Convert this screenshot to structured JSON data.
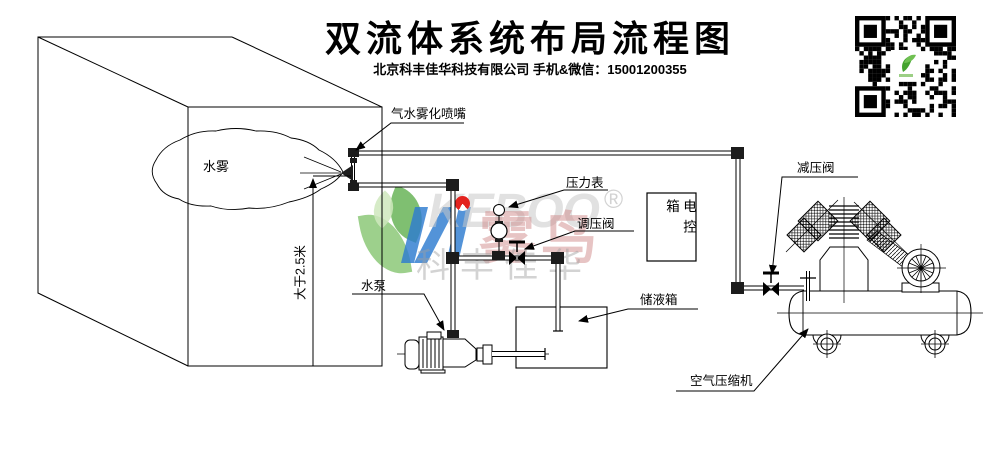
{
  "header": {
    "title": "双流体系统布局流程图",
    "subtitle": "北京科丰佳华科技有限公司 手机&微信：15001200355"
  },
  "labels": {
    "nozzle": "气水雾化喷嘴",
    "pressure_gauge": "压力表",
    "regulating_valve": "调压阀",
    "control_box": "电控箱",
    "water_mist": "水雾",
    "dimension": "大于2.5米",
    "water_pump": "水泵",
    "storage_tank": "储液箱",
    "reducing_valve": "减压阀",
    "air_compressor": "空气压缩机"
  },
  "watermark": {
    "brand_latin": "KEBOO",
    "registered": "®",
    "brand_cn": "雾鸟",
    "company_cn": "科丰佳华",
    "colors": {
      "blue": "#2e7cd0",
      "red": "#e3231f",
      "green": "#8cc878",
      "pink": "#d08a8a",
      "gray": "#c9c9c9"
    }
  }
}
